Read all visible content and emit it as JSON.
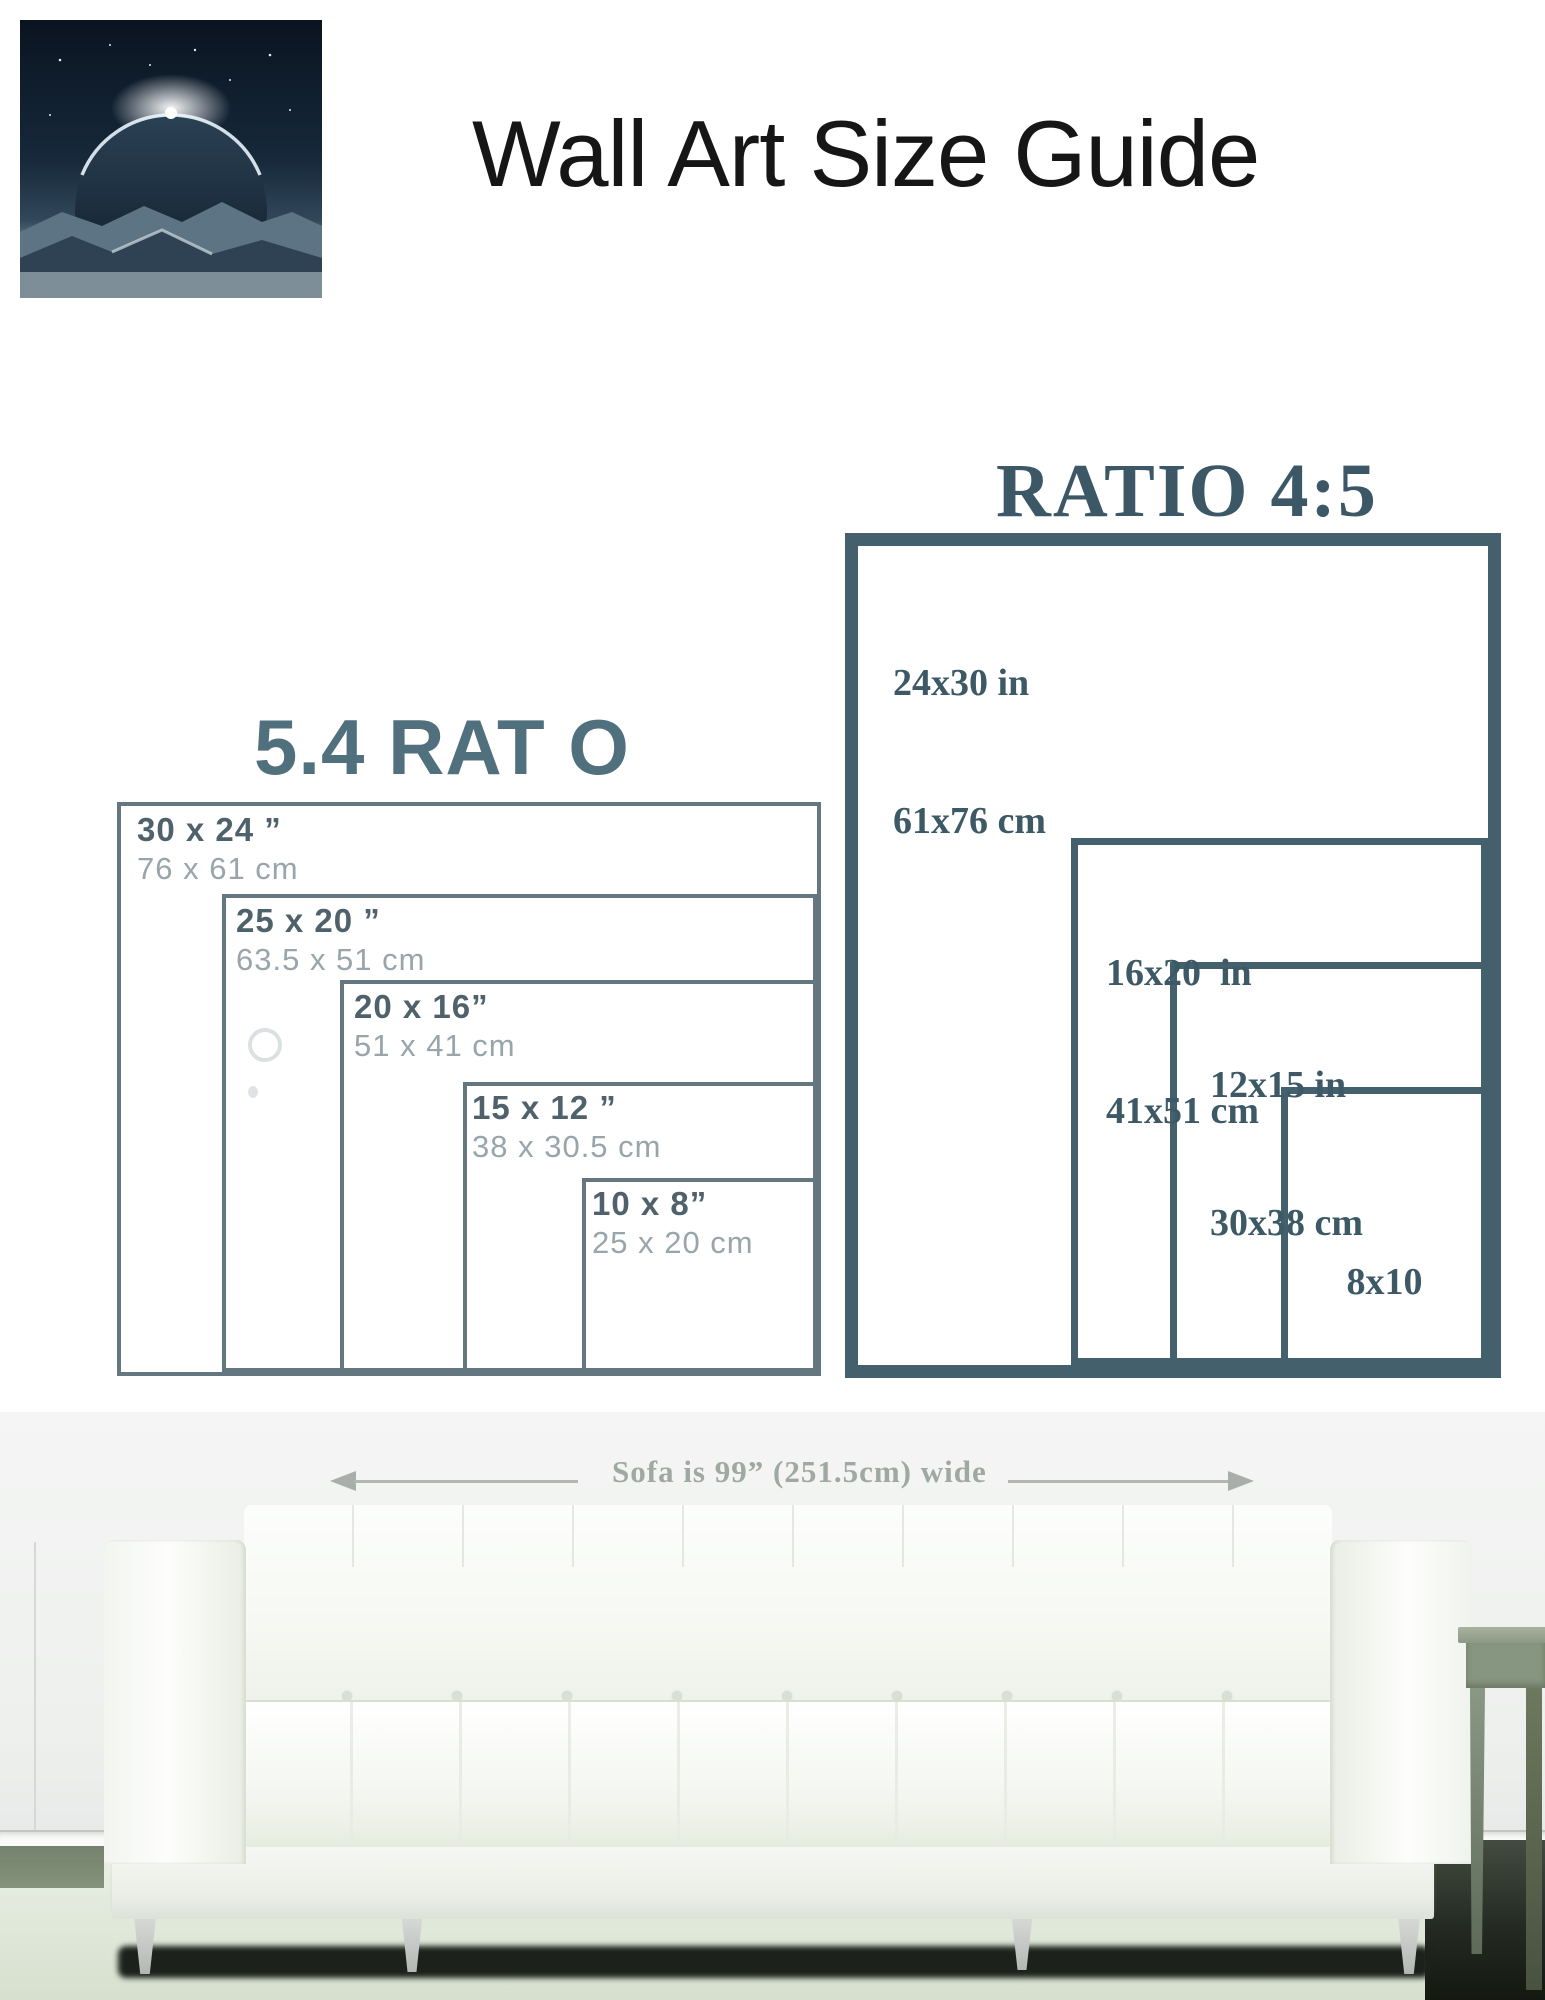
{
  "page": {
    "title": "Wall Art Size Guide"
  },
  "logo": {
    "brand": "O W Ξ"
  },
  "ratio45": {
    "title": "RATIO 4:5",
    "sizes": [
      {
        "inches": "24x30 in",
        "cm": "61x76 cm"
      },
      {
        "inches": "16x20  in",
        "cm": "41x51 cm"
      },
      {
        "inches": "12x15 in",
        "cm": "30x38 cm"
      },
      {
        "lines": [
          "8x10",
          "in",
          "20x25",
          "cm"
        ]
      }
    ]
  },
  "ratio54": {
    "title": "5.4 RAT O",
    "sizes": [
      {
        "inches": "30 x 24 ”",
        "cm": "76 x 61 cm"
      },
      {
        "inches": "25 x 20 ”",
        "cm": "63.5 x 51 cm"
      },
      {
        "inches": "20 x 16”",
        "cm": "51 x 41 cm"
      },
      {
        "inches": "15 x 12 ”",
        "cm": "38 x 30.5 cm"
      },
      {
        "inches": "10 x 8”",
        "cm": "25 x 20 cm"
      }
    ]
  },
  "sofa": {
    "width_label": "Sofa is 99” (251.5cm) wide"
  },
  "colors": {
    "frame_dark_slate": "#44606d",
    "frame_faded_gray": "#64767f",
    "serif_label": "#3d5966",
    "sans_label": "#4f626c",
    "cm_label": "#98a5ab",
    "ratio54_title": "#51707e",
    "sofa_label": "#a0a8a2"
  }
}
